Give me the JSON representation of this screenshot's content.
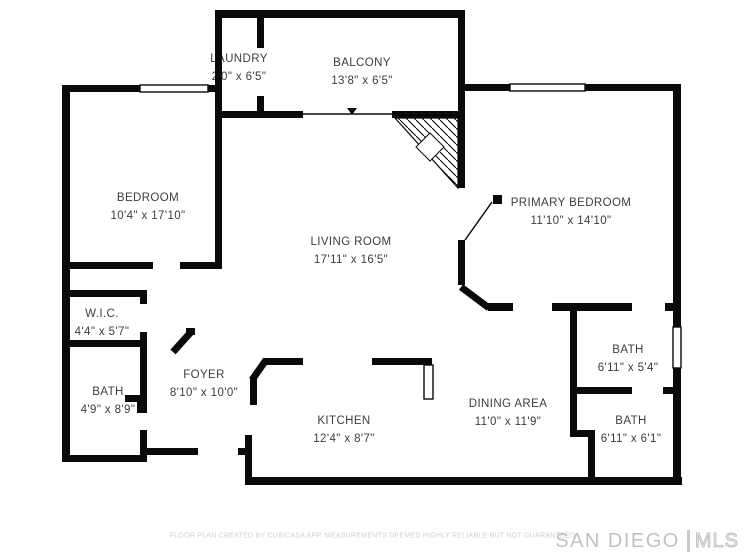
{
  "rooms": [
    {
      "name": "LAUNDRY",
      "dims": "2'0\" x 6'5\""
    },
    {
      "name": "BALCONY",
      "dims": "13'8\" x 6'5\""
    },
    {
      "name": "BEDROOM",
      "dims": "10'4\" x 17'10\""
    },
    {
      "name": "PRIMARY BEDROOM",
      "dims": "11'10\" x 14'10\""
    },
    {
      "name": "LIVING ROOM",
      "dims": "17'11\" x 16'5\""
    },
    {
      "name": "W.I.C.",
      "dims": "4'4\" x 5'7\""
    },
    {
      "name": "FOYER",
      "dims": "8'10\" x 10'0\""
    },
    {
      "name": "BATH",
      "dims": "4'9\" x 8'9\""
    },
    {
      "name": "KITCHEN",
      "dims": "12'4\" x 8'7\""
    },
    {
      "name": "DINING AREA",
      "dims": "11'0\" x 11'9\""
    },
    {
      "name": "BATH",
      "dims": "6'11\" x 5'4\""
    },
    {
      "name": "BATH",
      "dims": "6'11\" x 6'1\""
    }
  ],
  "footer": {
    "disclaimer": "FLOOR PLAN CREATED BY CUBICASA APP. MEASUREMENTS DEEMED HIGHLY RELIABLE BUT NOT GUARANTEED."
  },
  "brand": {
    "city": "SAN DIEGO",
    "mls": "MLS"
  },
  "colors": {
    "wall": "#0a0a0a",
    "label": "#3d3d3d",
    "muted": "#cfcfcf"
  }
}
